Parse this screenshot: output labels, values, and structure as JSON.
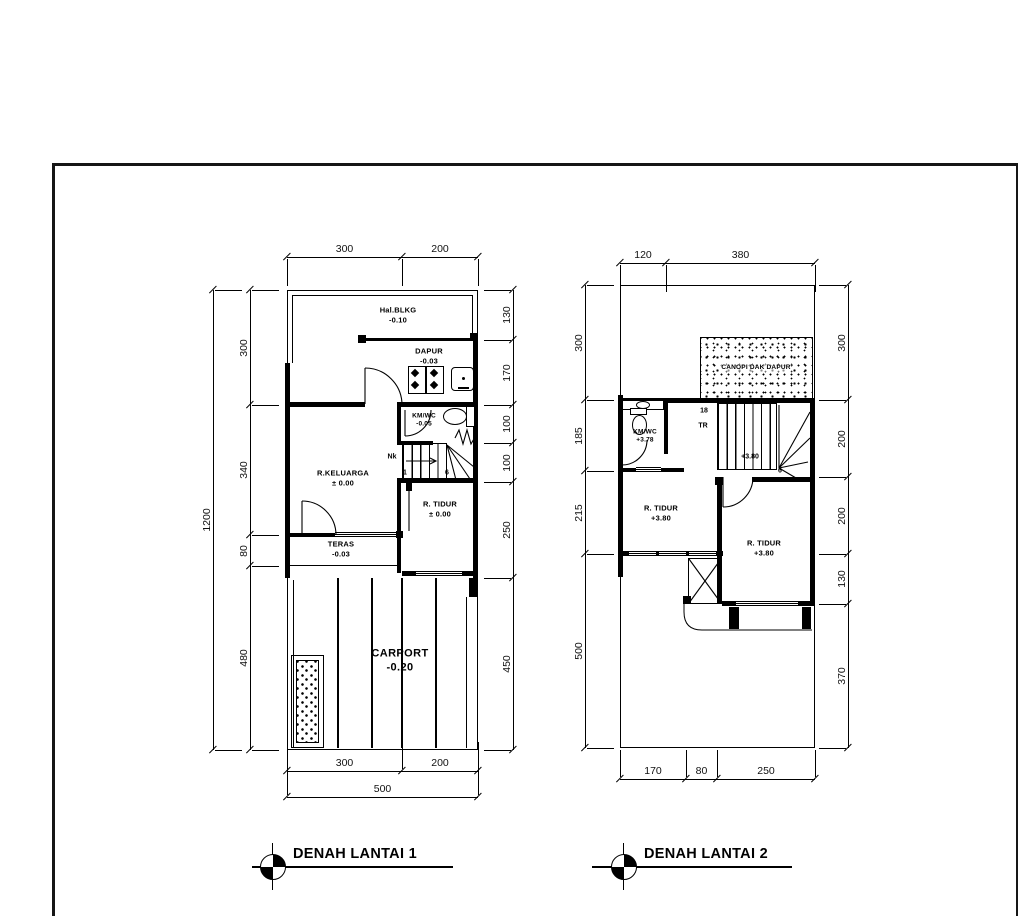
{
  "plan1": {
    "title": "DENAH LANTAI 1",
    "rooms": {
      "hal_blkg": {
        "name": "Hal.BLKG",
        "level": "-0.10"
      },
      "dapur": {
        "name": "DAPUR",
        "level": "-0.03"
      },
      "kmwc": {
        "name": "KM/WC",
        "level": "-0.05"
      },
      "keluarga": {
        "name": "R.KELUARGA",
        "level": "± 0.00"
      },
      "teras": {
        "name": "TERAS",
        "level": "-0.03"
      },
      "tidur": {
        "name": "R. TIDUR",
        "level": "± 0.00"
      },
      "carport": {
        "name": "CARPORT",
        "level": "-0.20"
      }
    },
    "stair": {
      "nk": "Nk",
      "first": "1",
      "last": "6"
    },
    "dims_top": [
      "300",
      "200"
    ],
    "dims_bottom": [
      "300",
      "200"
    ],
    "dims_bottom_total": [
      "500"
    ],
    "dims_left": [
      "300",
      "340",
      "80",
      "480"
    ],
    "dims_left_total": [
      "1200"
    ],
    "dims_right": [
      "130",
      "170",
      "100",
      "100",
      "250",
      "450"
    ]
  },
  "plan2": {
    "title": "DENAH LANTAI 2",
    "rooms": {
      "canopi": {
        "name": "CANOPI DAK DAPUR"
      },
      "kmwc": {
        "name": "KM/WC",
        "level": "+3.78"
      },
      "tidur_kiri": {
        "name": "R. TIDUR",
        "level": "+3.80"
      },
      "tidur_kanan": {
        "name": "R. TIDUR",
        "level": "+3.80"
      }
    },
    "stair": {
      "count": "18",
      "tr": "TR",
      "level": "+3.80",
      "last": "6"
    },
    "dims_top": [
      "120",
      "380"
    ],
    "dims_bottom": [
      "170",
      "80",
      "250"
    ],
    "dims_left": [
      "300",
      "185",
      "215",
      "500"
    ],
    "dims_right": [
      "300",
      "200",
      "200",
      "130",
      "370"
    ]
  }
}
